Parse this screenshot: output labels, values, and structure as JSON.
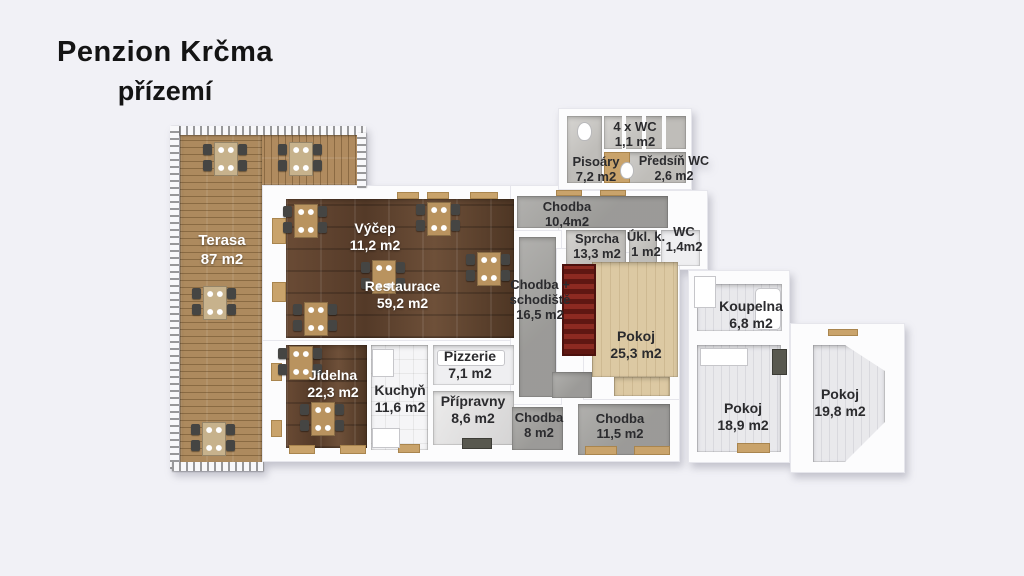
{
  "title": {
    "line1": "Penzion Krčma",
    "line2": "přízemí"
  },
  "rooms": {
    "terasa": {
      "name": "Terasa",
      "area": "87 m2"
    },
    "vycep": {
      "name": "Výčep",
      "area": "11,2 m2"
    },
    "restaurace": {
      "name": "Restaurace",
      "area": "59,2 m2"
    },
    "jidelna": {
      "name": "Jídelna",
      "area": "22,3 m2"
    },
    "kuchyn": {
      "name": "Kuchyň",
      "area": "11,6 m2"
    },
    "pizzerie": {
      "name": "Pizzerie",
      "area": "7,1 m2"
    },
    "pripravny": {
      "name": "Přípravny",
      "area": "8,6 m2"
    },
    "chodba_8": {
      "name": "Chodba",
      "area": "8 m2"
    },
    "chodba_115": {
      "name": "Chodba",
      "area": "11,5 m2"
    },
    "chodba_104": {
      "name": "Chodba",
      "area": "10,4m2"
    },
    "chodba_schodiste": {
      "line1": "Chodba +",
      "line2": "schodiště",
      "area": "16,5 m2"
    },
    "sprcha": {
      "name": "Sprcha",
      "area": "13,3 m2"
    },
    "ukl": {
      "name": "Úkl. k.",
      "area": "1 m2"
    },
    "wc": {
      "name": "WC",
      "area": "1,4m2"
    },
    "wc4": {
      "name": "4 x WC",
      "area": "1,1 m2"
    },
    "pisoary": {
      "name": "Pisoáry",
      "area": "7,2 m2"
    },
    "predsin_wc": {
      "name": "Předsíň WC",
      "area": "2,6 m2"
    },
    "pokoj_253": {
      "name": "Pokoj",
      "area": "25,3 m2"
    },
    "koupelna": {
      "name": "Koupelna",
      "area": "6,8 m2"
    },
    "pokoj_189": {
      "name": "Pokoj",
      "area": "18,9 m2"
    },
    "pokoj_198": {
      "name": "Pokoj",
      "area": "19,8 m2"
    }
  },
  "colors": {
    "background": "#f1f1f6",
    "dark_wood": "#5d4230",
    "terrace_wood": "#b08b5f",
    "corridor_concrete": "#a5a4a1",
    "bedroom_beige": "#dcc9a3",
    "stairs_red": "#7c221c",
    "label_dark": "#2b2b2e",
    "label_light": "#ffffff"
  }
}
